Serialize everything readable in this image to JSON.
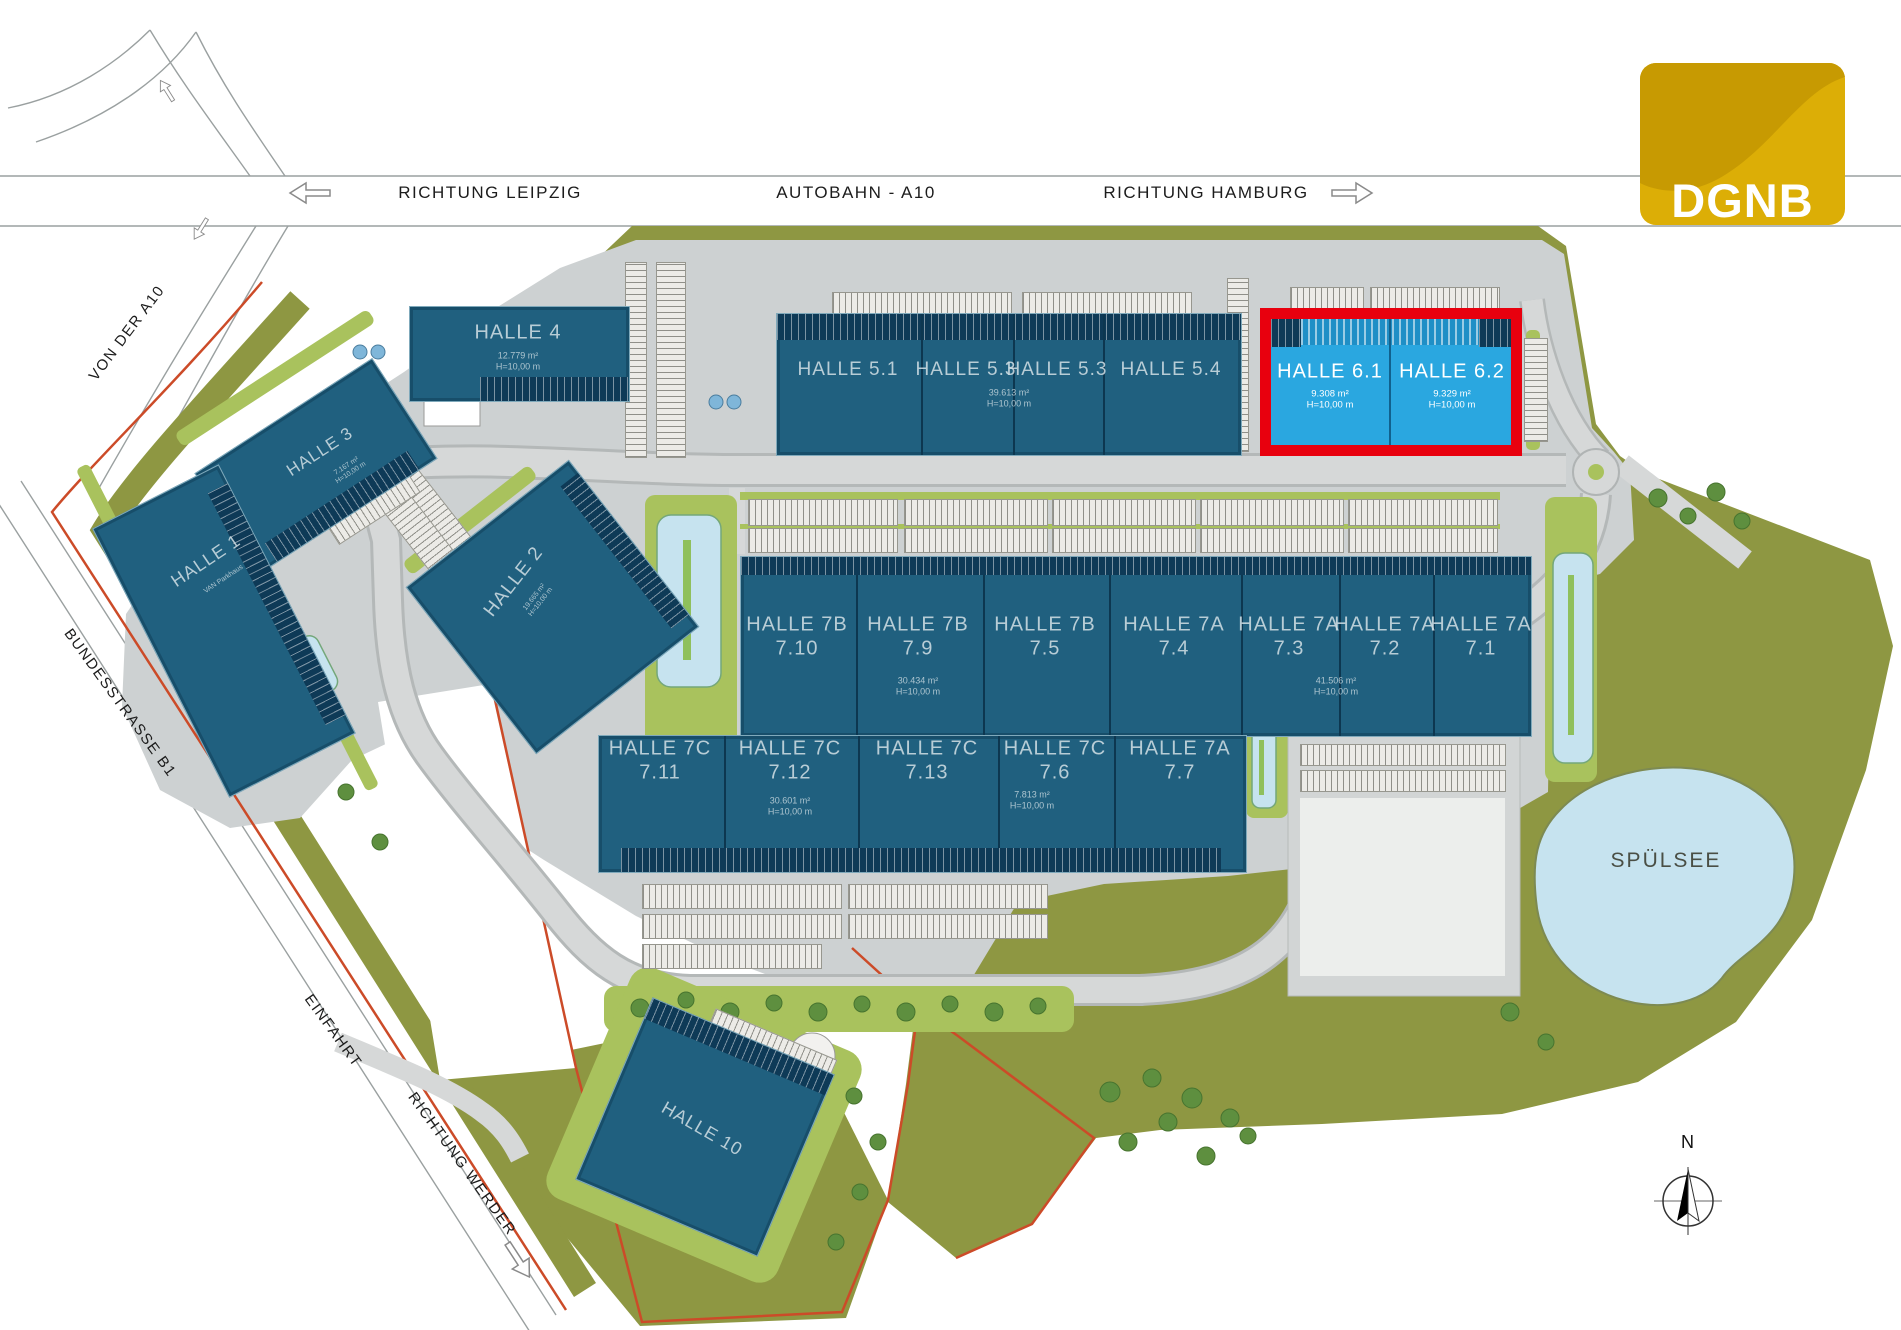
{
  "roads": {
    "richtung_leipzig": "RICHTUNG LEIPZIG",
    "autobahn": "AUTOBAHN - A10",
    "richtung_hamburg": "RICHTUNG HAMBURG",
    "von_der_a10": "VON DER A10",
    "bundesstrasse": "BUNDESSTRASSE B1",
    "einfahrt": "EINFAHRT",
    "richtung_werder": "RICHTUNG WERDER"
  },
  "lake": {
    "label": "SPÜLSEE"
  },
  "compass": {
    "north": "N"
  },
  "logo": {
    "text": "DGNB"
  },
  "common": {
    "height": "H=10,00 m"
  },
  "halls": {
    "h1": {
      "name": "HALLE 1",
      "sub": "VAN Parkhaus"
    },
    "h2": {
      "name": "HALLE 2",
      "area": "19.665 m²"
    },
    "h3": {
      "name": "HALLE 3",
      "area": "7.167 m²"
    },
    "h4": {
      "name": "HALLE 4",
      "area": "12.779 m²"
    },
    "h5": {
      "c1": "HALLE 5.1",
      "c2": "HALLE 5.3",
      "c3": "HALLE 5.3",
      "c4": "HALLE 5.4",
      "area": "39.613 m²"
    },
    "h6": {
      "c1": {
        "name": "HALLE 6.1",
        "area": "9.308 m²"
      },
      "c2": {
        "name": "HALLE 6.2",
        "area": "9.329 m²"
      }
    },
    "h7": {
      "r1": [
        {
          "t": "HALLE 7B",
          "n": "7.10"
        },
        {
          "t": "HALLE 7B",
          "n": "7.9"
        },
        {
          "t": "HALLE 7B",
          "n": "7.5"
        },
        {
          "t": "HALLE 7A",
          "n": "7.4"
        },
        {
          "t": "HALLE 7A",
          "n": "7.3"
        },
        {
          "t": "HALLE 7A",
          "n": "7.2"
        },
        {
          "t": "HALLE 7A",
          "n": "7.1"
        }
      ],
      "r2": [
        {
          "t": "HALLE 7C",
          "n": "7.11"
        },
        {
          "t": "HALLE 7C",
          "n": "7.12"
        },
        {
          "t": "HALLE 7C",
          "n": "7.13"
        },
        {
          "t": "HALLE 7C",
          "n": "7.6"
        },
        {
          "t": "HALLE 7A",
          "n": "7.7"
        }
      ],
      "area_7b": "30.434 m²",
      "area_7a": "41.506 m²",
      "area_7c": "30.601 m²",
      "area_76": "7.813 m²"
    },
    "h10": {
      "name": "HALLE 10"
    }
  },
  "colors": {
    "highlight_red": "#e8000e",
    "hall_blue": "#20607f",
    "available_blue": "#2aa7e0",
    "site_green": "#8e9742",
    "landscape_green": "#a9c25d",
    "water_blue": "#c6e3ef",
    "logo_gold": "#d9ab07"
  }
}
